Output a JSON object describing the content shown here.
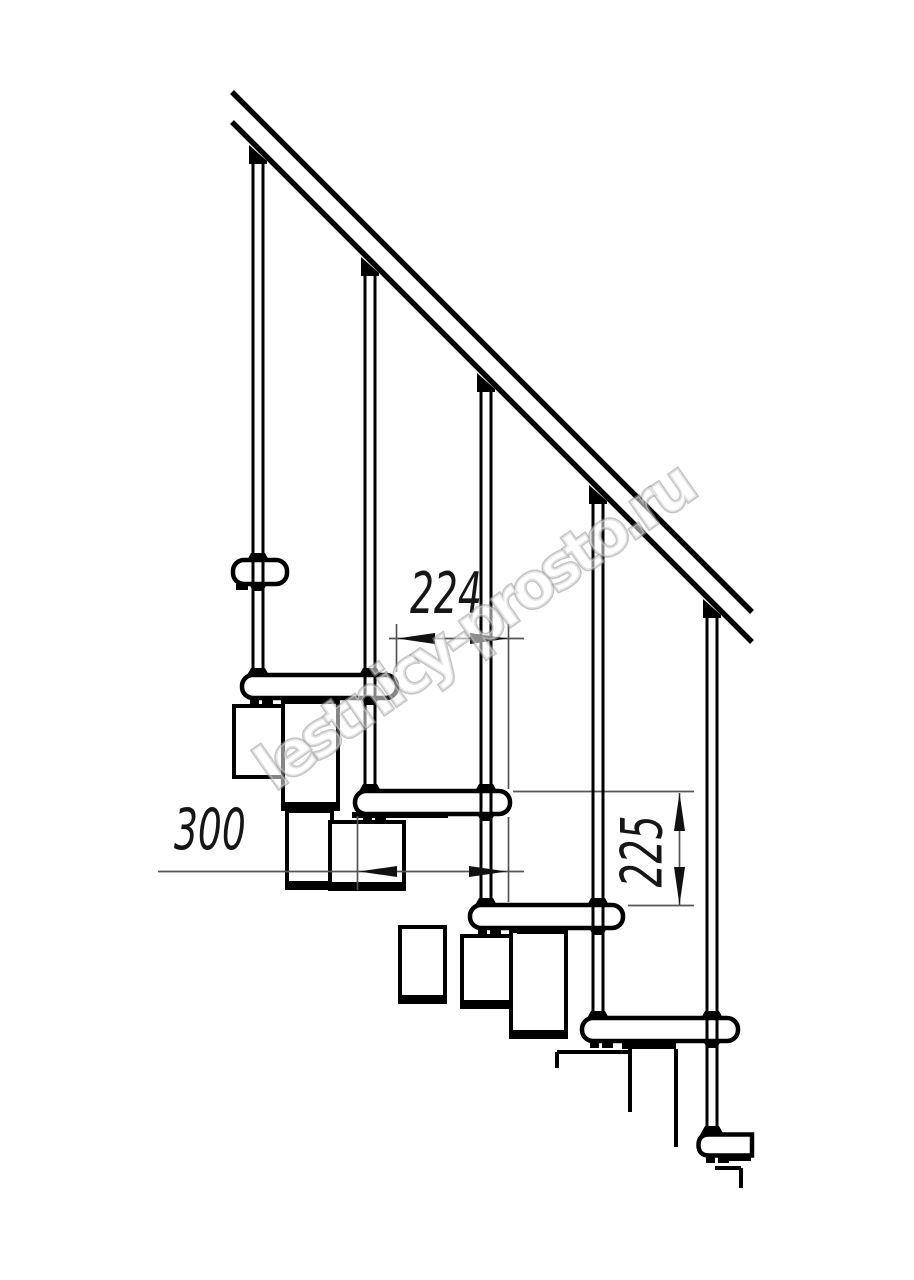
{
  "page": {
    "background_color": "#ffffff",
    "width": 914,
    "height": 1280,
    "description": "Technical side-elevation line drawing of a modular staircase with handrail, balusters, treads and spine modules"
  },
  "drawing": {
    "line_color": "#000000",
    "dim_line_color": "#555555",
    "dimensions": [
      {
        "id": "step-run",
        "value": "224",
        "orientation": "horizontal"
      },
      {
        "id": "tread-depth",
        "value": "300",
        "orientation": "horizontal"
      },
      {
        "id": "step-rise",
        "value": "225",
        "orientation": "vertical"
      }
    ],
    "watermark": {
      "text": "lestnicy-prosto.ru",
      "outline_color": "#969696",
      "fill_color": "#ffffff",
      "angle_deg": -35
    },
    "components": {
      "handrail_count": 1,
      "baluster_count": 5,
      "tread_count": 6,
      "support_module_count": 8
    }
  }
}
